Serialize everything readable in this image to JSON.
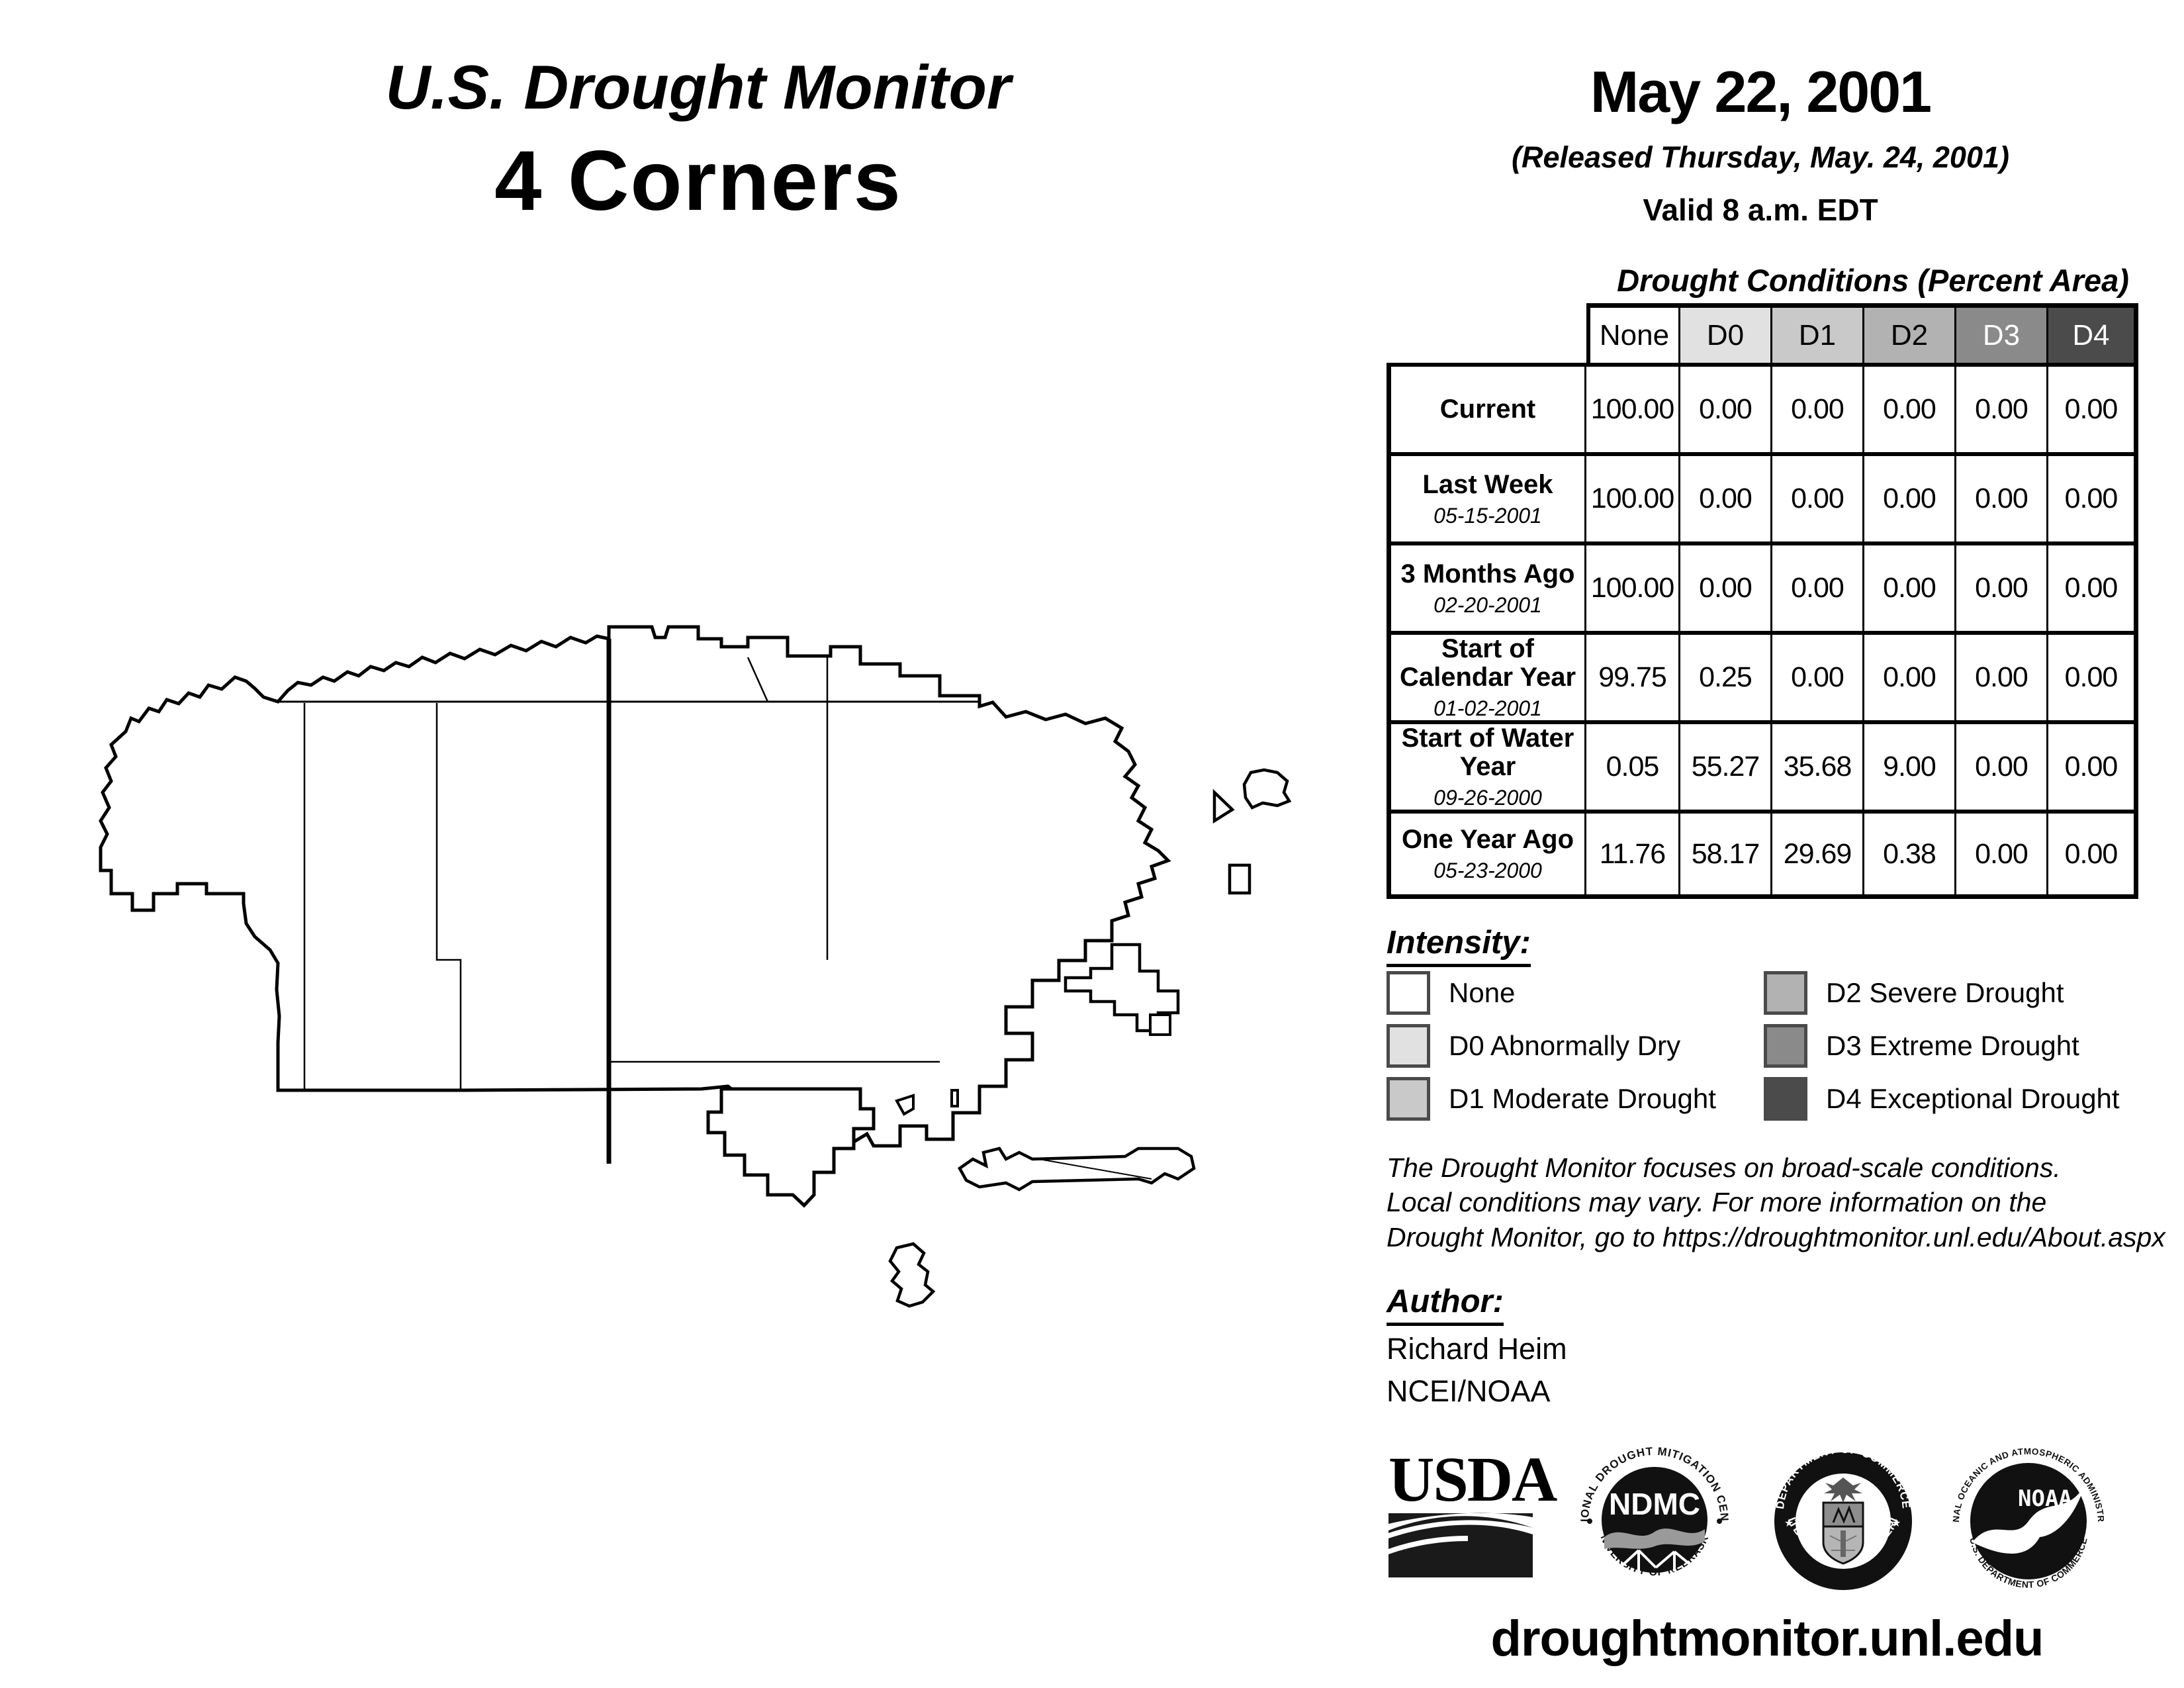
{
  "header": {
    "title": "U.S. Drought Monitor",
    "region": "4 Corners"
  },
  "date_block": {
    "date": "May 22, 2001",
    "released": "(Released Thursday, May. 24, 2001)",
    "valid": "Valid 8 a.m. EDT"
  },
  "table": {
    "title": "Drought Conditions (Percent Area)",
    "columns": [
      "None",
      "D0",
      "D1",
      "D2",
      "D3",
      "D4"
    ],
    "column_colors": [
      "#ffffff",
      "#e1e1e1",
      "#c9c9c9",
      "#b2b2b2",
      "#8a8a8a",
      "#4b4b4b"
    ],
    "column_text_colors": [
      "#000000",
      "#000000",
      "#000000",
      "#000000",
      "#ffffff",
      "#ffffff"
    ],
    "rows": [
      {
        "label": "Current",
        "date": "",
        "values": [
          "100.00",
          "0.00",
          "0.00",
          "0.00",
          "0.00",
          "0.00"
        ]
      },
      {
        "label": "Last Week",
        "date": "05-15-2001",
        "values": [
          "100.00",
          "0.00",
          "0.00",
          "0.00",
          "0.00",
          "0.00"
        ]
      },
      {
        "label": "3 Months Ago",
        "date": "02-20-2001",
        "values": [
          "100.00",
          "0.00",
          "0.00",
          "0.00",
          "0.00",
          "0.00"
        ]
      },
      {
        "label": "Start of Calendar Year",
        "date": "01-02-2001",
        "values": [
          "99.75",
          "0.25",
          "0.00",
          "0.00",
          "0.00",
          "0.00"
        ]
      },
      {
        "label": "Start of Water Year",
        "date": "09-26-2000",
        "values": [
          "0.05",
          "55.27",
          "35.68",
          "9.00",
          "0.00",
          "0.00"
        ]
      },
      {
        "label": "One Year Ago",
        "date": "05-23-2000",
        "values": [
          "11.76",
          "58.17",
          "29.69",
          "0.38",
          "0.00",
          "0.00"
        ]
      }
    ]
  },
  "legend": {
    "heading": "Intensity:",
    "items": [
      {
        "label": "None",
        "color": "#ffffff"
      },
      {
        "label": "D0 Abnormally Dry",
        "color": "#e1e1e1"
      },
      {
        "label": "D1 Moderate Drought",
        "color": "#c9c9c9"
      },
      {
        "label": "D2 Severe Drought",
        "color": "#b2b2b2"
      },
      {
        "label": "D3 Extreme Drought",
        "color": "#8a8a8a"
      },
      {
        "label": "D4 Exceptional Drought",
        "color": "#4b4b4b"
      }
    ]
  },
  "disclaimer": {
    "line1": "The Drought Monitor focuses on broad-scale conditions.",
    "line2": "Local conditions may vary. For more information on the",
    "line3": "Drought Monitor, go to https://droughtmonitor.unl.edu/About.aspx"
  },
  "author": {
    "heading": "Author:",
    "name": "Richard Heim",
    "org": "NCEI/NOAA"
  },
  "logos": {
    "usda": {
      "text": "USDA"
    },
    "ndmc": {
      "center": "NDMC",
      "arc_top": "NATIONAL DROUGHT MITIGATION CENTER",
      "arc_bottom": "UNIVERSITY OF NEBRASKA"
    },
    "doc": {
      "arc_top": "DEPARTMENT OF COMMERCE",
      "arc_bottom": "UNITED STATES OF AMERICA"
    },
    "noaa": {
      "center": "NOAA",
      "arc_top": "NATIONAL OCEANIC AND ATMOSPHERIC ADMINISTRATION",
      "arc_bottom": "U.S. DEPARTMENT OF COMMERCE"
    }
  },
  "footer": {
    "url": "droughtmonitor.unl.edu"
  },
  "map": {
    "region": "4 Corners"
  }
}
